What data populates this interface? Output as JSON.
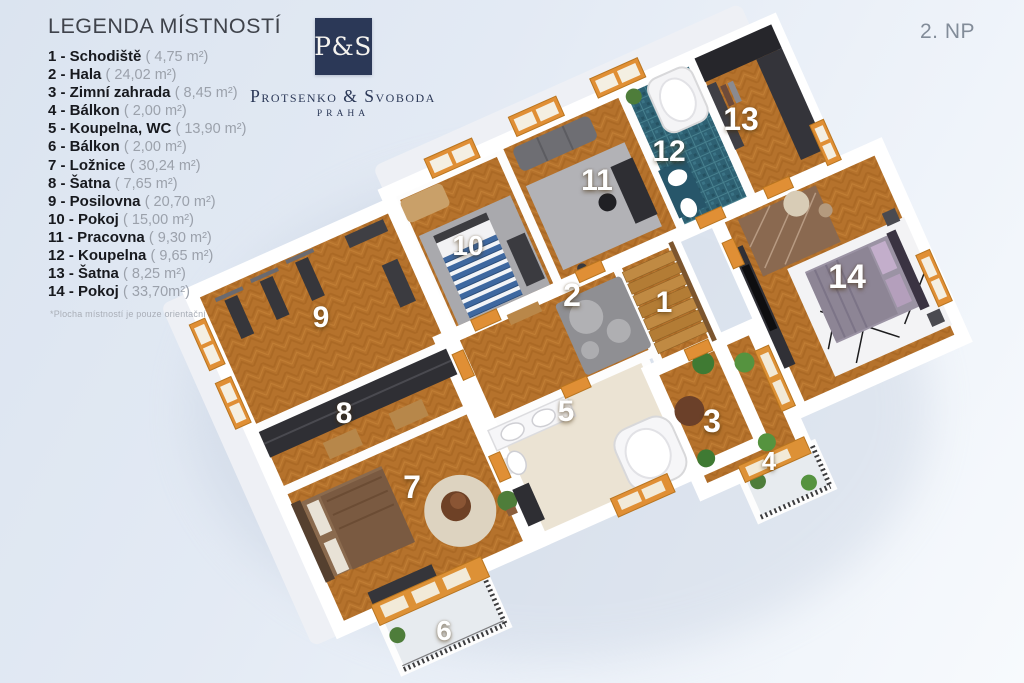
{
  "page": {
    "floor_label": "2. NP"
  },
  "legend": {
    "title": "LEGENDA MÍSTNOSTÍ",
    "footnote": "*Plocha místností je pouze orientační",
    "items": [
      {
        "num": "1",
        "name": "Schodiště",
        "area": "( 4,75 m²)"
      },
      {
        "num": "2",
        "name": "Hala",
        "area": "( 24,02 m²)"
      },
      {
        "num": "3",
        "name": "Zimní zahrada",
        "area": "( 8,45 m²)"
      },
      {
        "num": "4",
        "name": "Bálkon",
        "area": "( 2,00 m²)"
      },
      {
        "num": "5",
        "name": "Koupelna, WC",
        "area": "( 13,90 m²)"
      },
      {
        "num": "6",
        "name": "Bálkon",
        "area": "( 2,00 m²)"
      },
      {
        "num": "7",
        "name": "Ložnice",
        "area": "( 30,24 m²)"
      },
      {
        "num": "8",
        "name": "Šatna",
        "area": "( 7,65 m²)"
      },
      {
        "num": "9",
        "name": "Posilovna",
        "area": "( 20,70 m²)"
      },
      {
        "num": "10",
        "name": "Pokoj",
        "area": "( 15,00 m²)"
      },
      {
        "num": "11",
        "name": "Pracovna",
        "area": "( 9,30 m²)"
      },
      {
        "num": "12",
        "name": "Koupelna",
        "area": "( 9,65 m²)"
      },
      {
        "num": "13",
        "name": "Šatna",
        "area": "( 8,25 m²)"
      },
      {
        "num": "14",
        "name": "Pokoj",
        "area": "( 33,70m²)"
      }
    ]
  },
  "logo": {
    "monogram": "P&S",
    "company": "Protsenko & Svoboda",
    "city": "PRAHA"
  },
  "colors": {
    "brand_navy": "#2b3857",
    "wood_floor": "#b5722c",
    "frame_orange": "#e08f35",
    "bath_teal": "#2e6173",
    "bath_cream": "#ebe3d3",
    "background": "#e3eaf4"
  }
}
